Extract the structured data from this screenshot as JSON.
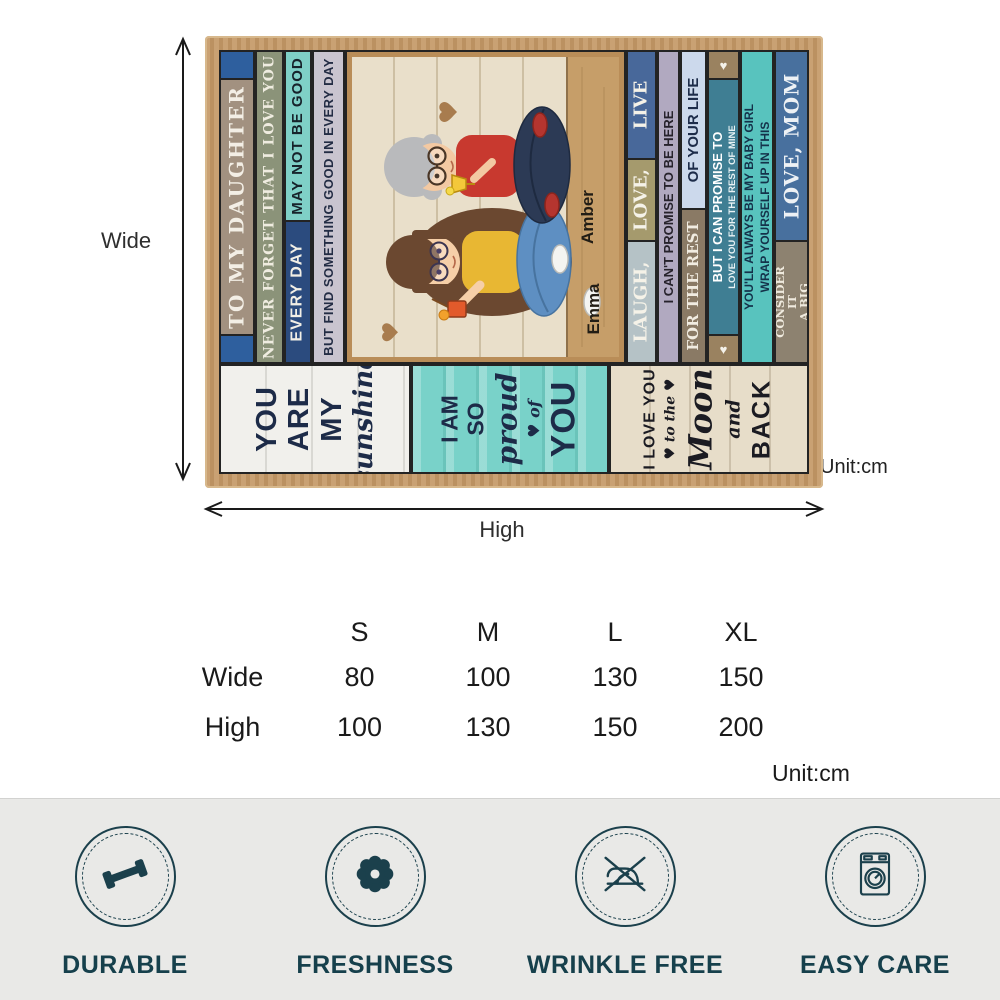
{
  "dimension_guide": {
    "wide_label": "Wide",
    "high_label": "High",
    "blanket_unit_label": "Unit:cm"
  },
  "blanket": {
    "left_strips": {
      "to_my_daughter": "♥ TO MY DAUGHTER ♥",
      "never_forget": "NEVER FORGET THAT I LOVE YOU",
      "may_not_be_good": "MAY NOT BE GOOD",
      "every_day": "EVERY DAY",
      "but_find": "BUT FIND SOMETHING GOOD IN EVERY DAY"
    },
    "right_strips": {
      "laugh": "LAUGH,",
      "love": "LOVE,",
      "live": "LIVE",
      "cant_promise": "I CAN'T PROMISE TO BE HERE",
      "of_your_life": "OF YOUR LIFE",
      "for_the_rest": "FOR THE REST",
      "promise_line1": "BUT I CAN PROMISE TO",
      "promise_line2": "LOVE YOU FOR THE REST OF MINE",
      "heart": "♥",
      "baby_line1": "YOU'LL ALWAYS BE MY BABY GIRL",
      "baby_line2": "WRAP YOURSELF UP IN THIS",
      "consider": "& CONSIDER IT\nA BIG HUG",
      "love_mom": "LOVE, MOM"
    },
    "bottom_panels": {
      "you_are_my": "YOU\nARE\nMY",
      "sunshine": "sunshine",
      "i_am_so": "I AM\nSO",
      "proud": "proud",
      "of": "♥ of",
      "you": "YOU",
      "i_love_you": "I LOVE YOU",
      "to_the": "♥ to the ♥",
      "moon": "Moon",
      "and": "and",
      "back": "BACK"
    },
    "photo_names": [
      "Amber",
      "Emma"
    ]
  },
  "size_table": {
    "columns": [
      "S",
      "M",
      "L",
      "XL"
    ],
    "rows": [
      {
        "label": "Wide",
        "values": [
          "80",
          "100",
          "130",
          "150"
        ]
      },
      {
        "label": "High",
        "values": [
          "100",
          "130",
          "150",
          "200"
        ]
      }
    ],
    "unit_label": "Unit:cm"
  },
  "features": [
    {
      "label": "DURABLE",
      "icon": "dumbbell-icon"
    },
    {
      "label": "FRESHNESS",
      "icon": "flower-icon"
    },
    {
      "label": "WRINKLE FREE",
      "icon": "no-iron-icon"
    },
    {
      "label": "EASY CARE",
      "icon": "washing-machine-icon"
    }
  ],
  "colors": {
    "feature_teal": "#1b404c",
    "burlap_border": "#c49a6b",
    "turquoise_strip": "#58c3be",
    "navy_text": "#1d2b48",
    "features_bar_bg": "#e9e9e7"
  }
}
